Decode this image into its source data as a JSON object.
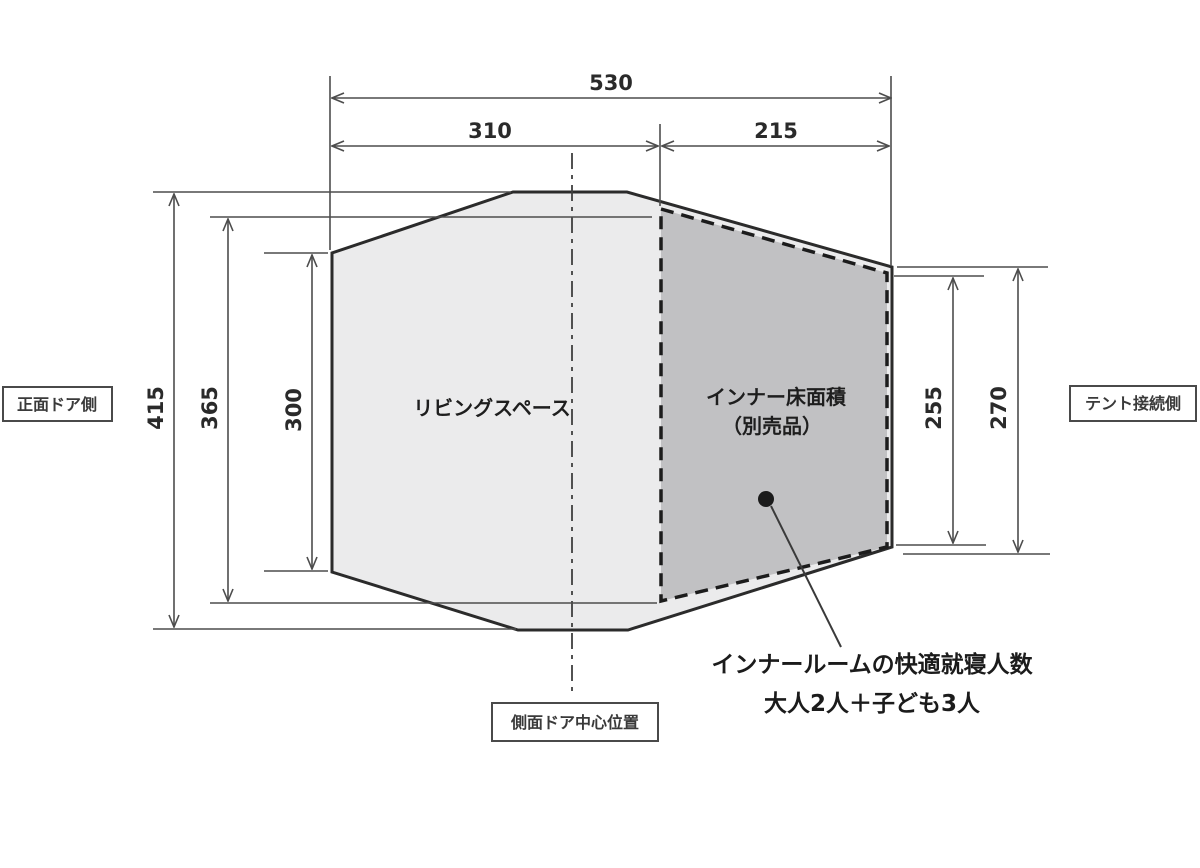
{
  "diagram": {
    "title_hint": "tent-floorplan-dimension-drawing",
    "dims": {
      "top_total": "530",
      "top_left": "310",
      "top_right": "215",
      "left_outer": "415",
      "left_middle": "365",
      "left_inner": "300",
      "right_inner": "255",
      "right_outer": "270"
    },
    "labels": {
      "front_door_side": "正面ドア側",
      "tent_connection_side": "テント接続側",
      "side_door_center": "側面ドア中心位置",
      "living_space": "リビングスペース",
      "inner_floor_line1": "インナー床面積",
      "inner_floor_line2": "（別売品）",
      "annotation_line1": "インナールームの快適就寝人数",
      "annotation_line2": "大人2人＋子ども3人"
    },
    "colors": {
      "outline": "#2b2b2b",
      "dimension_lines": "#4d4d4d",
      "living_fill": "#ebebec",
      "inner_fill": "#c1c1c3",
      "background": "#ffffff"
    }
  }
}
